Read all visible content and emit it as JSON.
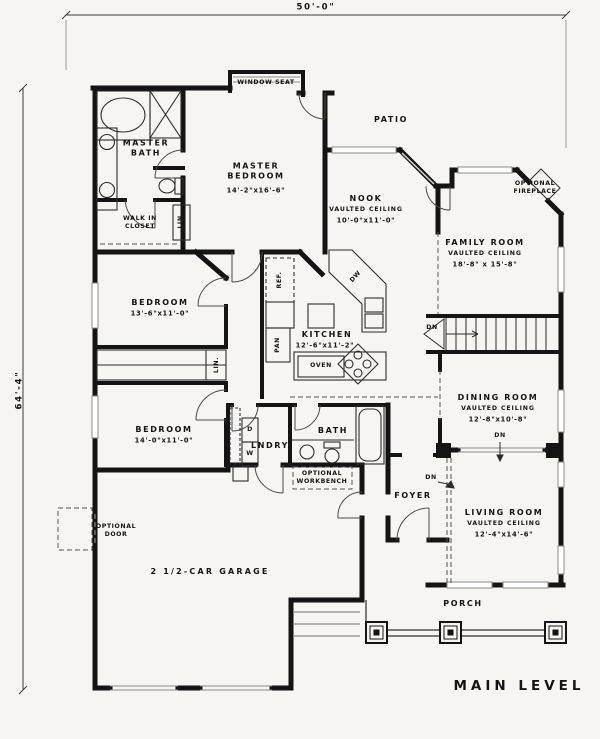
{
  "title": "MAIN LEVEL",
  "dimensions": {
    "top": "50'-0\"",
    "left": "64'-4\""
  },
  "rooms": {
    "master_bath": {
      "name": "MASTER BATH"
    },
    "walk_in_closet": {
      "name": "WALK IN CLOSET"
    },
    "master_bedroom": {
      "name": "MASTER BEDROOM",
      "size": "14'-2\"x16'-6\""
    },
    "patio": {
      "name": "PATIO"
    },
    "nook": {
      "name": "NOOK",
      "note": "VAULTED CEILING",
      "size": "10'-0\"x11'-0\""
    },
    "family_room": {
      "name": "FAMILY ROOM",
      "note": "VAULTED CEILING",
      "size": "18'-8\" x 15'-8\""
    },
    "bedroom_front": {
      "name": "BEDROOM",
      "size": "13'-6\"x11'-0\""
    },
    "kitchen": {
      "name": "KITCHEN",
      "size": "12'-6\"x11'-2\""
    },
    "dining_room": {
      "name": "DINING ROOM",
      "note": "VAULTED CEILING",
      "size": "12'-8\"x10'-8\""
    },
    "bedroom_rear": {
      "name": "BEDROOM",
      "size": "14'-0\"x11'-0\""
    },
    "laundry": {
      "name": "LNDRY"
    },
    "bath": {
      "name": "BATH"
    },
    "foyer": {
      "name": "FOYER"
    },
    "living_room": {
      "name": "LIVING ROOM",
      "note": "VAULTED CEILING",
      "size": "12'-4\"x14'-6\""
    },
    "garage": {
      "name": "2 1/2-CAR GARAGE"
    },
    "porch": {
      "name": "PORCH"
    }
  },
  "annotations": {
    "window_seat": "WINDOW SEAT",
    "optional_fireplace": "OPTIONAL FIREPLACE",
    "optional_workbench": "OPTIONAL WORKBENCH",
    "optional_door": "OPTIONAL DOOR",
    "oven": "OVEN",
    "ref": "REF.",
    "pan": "PAN",
    "dw": "DW",
    "lin": "LIN",
    "lin2": "LIN.",
    "dryer": "D",
    "washer": "W",
    "dn": "DN"
  },
  "colors": {
    "ink": "#141414",
    "paper": "#f6f5f2",
    "lightline": "#8a8a86"
  }
}
